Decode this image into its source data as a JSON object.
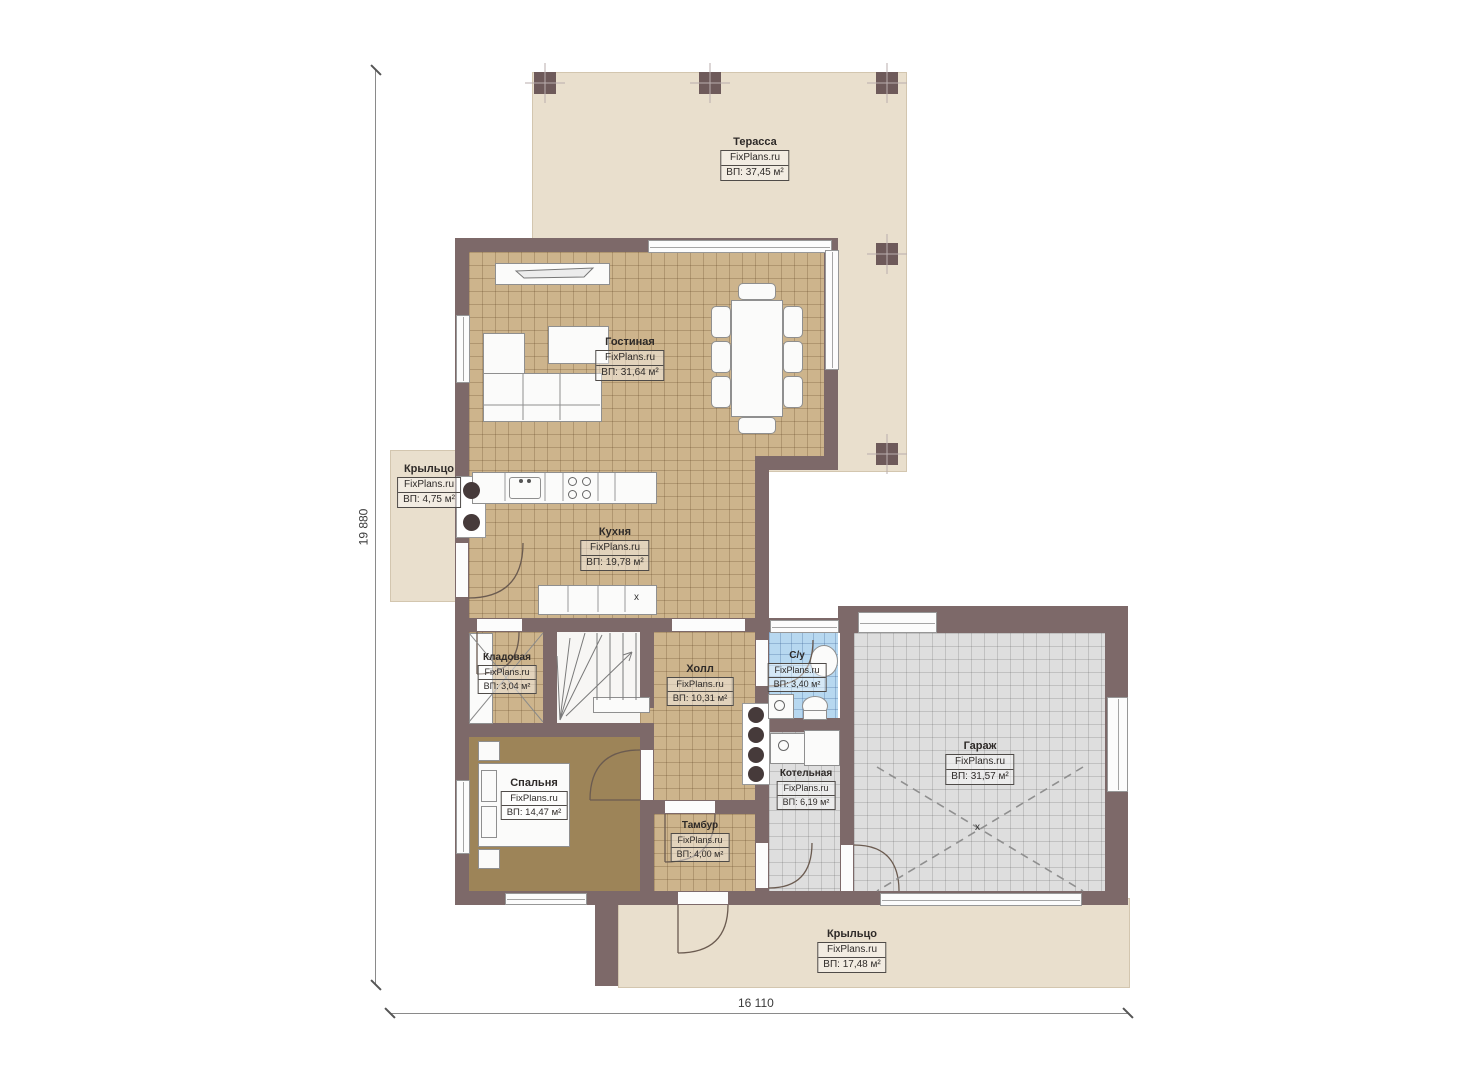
{
  "brand": "FixPlans.ru",
  "dimensions": {
    "left_vertical": "19 880",
    "bottom_horizontal": "16 110"
  },
  "markers": {
    "kitchen_island": "x",
    "garage_center": "x"
  },
  "colors": {
    "wall": "#7d6969",
    "floor_wood": "#cdb48c",
    "floor_bedroom": "#9d8458",
    "floor_tile_gray": "#dedede",
    "floor_tile_blue": "#b7d8f0",
    "outdoor": "#e9dfcd"
  },
  "rooms": [
    {
      "name": "Терасса",
      "area": "ВП: 37,45 м²"
    },
    {
      "name": "Гостиная",
      "area": "ВП: 31,64 м²"
    },
    {
      "name": "Кухня",
      "area": "ВП: 19,78 м²"
    },
    {
      "name": "Крыльцо",
      "area": "ВП: 4,75 м²"
    },
    {
      "name": "Кладовая",
      "area": "ВП: 3,04 м²"
    },
    {
      "name": "Холл",
      "area": "ВП: 10,31 м²"
    },
    {
      "name": "С/у",
      "area": "ВП: 3,40 м²"
    },
    {
      "name": "Гараж",
      "area": "ВП: 31,57 м²"
    },
    {
      "name": "Котельная",
      "area": "ВП: 6,19 м²"
    },
    {
      "name": "Спальня",
      "area": "ВП: 14,47 м²"
    },
    {
      "name": "Тамбур",
      "area": "ВП: 4,00 м²"
    },
    {
      "name": "Крыльцо",
      "area": "ВП: 17,48 м²"
    }
  ]
}
